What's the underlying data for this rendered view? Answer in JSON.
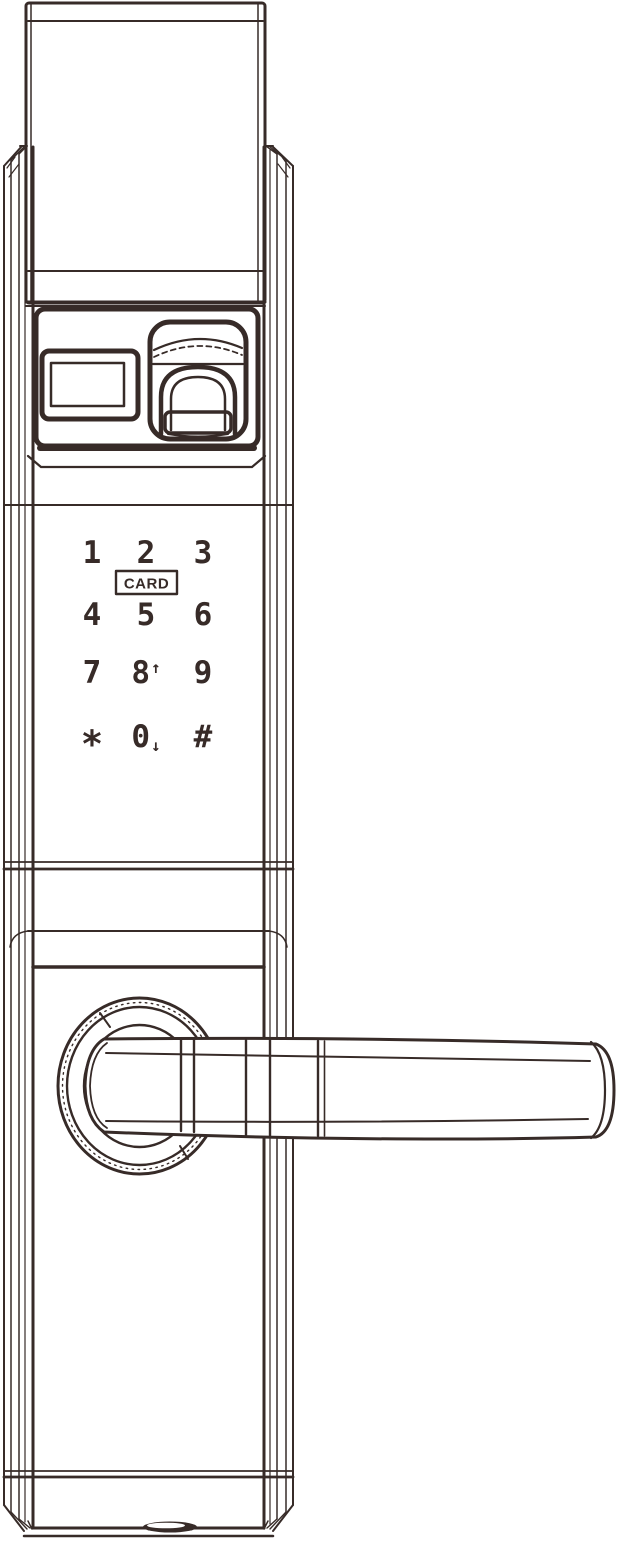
{
  "colors": {
    "ink": "#372b28",
    "background": "#ffffff"
  },
  "keypad": {
    "card_label": "CARD",
    "keys": [
      {
        "label": "1",
        "suffix": ""
      },
      {
        "label": "2",
        "suffix": ""
      },
      {
        "label": "3",
        "suffix": ""
      },
      {
        "label": "4",
        "suffix": ""
      },
      {
        "label": "5",
        "suffix": ""
      },
      {
        "label": "6",
        "suffix": ""
      },
      {
        "label": "7",
        "suffix": ""
      },
      {
        "label": "8",
        "suffix": "↑"
      },
      {
        "label": "9",
        "suffix": ""
      },
      {
        "label": "*",
        "suffix": ""
      },
      {
        "label": "0",
        "suffix": "↓"
      },
      {
        "label": "#",
        "suffix": ""
      }
    ]
  },
  "components": {
    "top_cover": "top-cover-cap",
    "lock_body": "lock-body",
    "display_window": "display-window",
    "fingerprint_scanner": "fingerprint-scanner",
    "card_reader_zone": "card-reader",
    "touch_keypad": "touch-keypad",
    "handle_rosette": "handle-rosette",
    "lever_handle": "lever-handle",
    "bottom_port": "bottom-port"
  }
}
